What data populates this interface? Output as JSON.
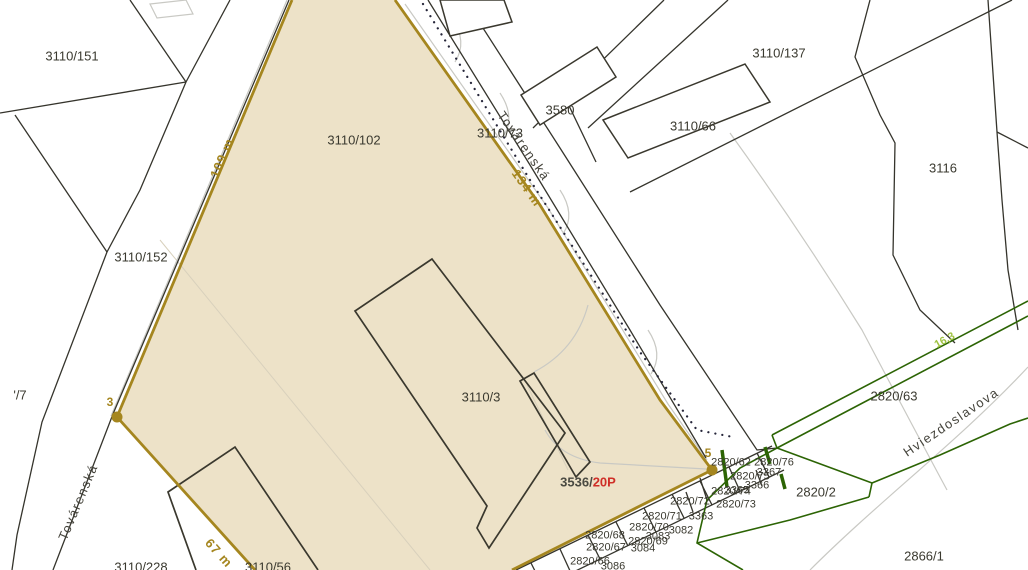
{
  "map": {
    "title": "cadastral-map-view",
    "colors": {
      "highlight_fill": "#ede2c8",
      "highlight_border": "#a5861f",
      "parcel_line": "#35342c",
      "building_line": "#3a382e",
      "helper_gray": "#c9c9c4",
      "dotted_line": "#26263a",
      "green_line": "#2c6404",
      "green_label": "#9fc241",
      "red_label": "#cf2e27",
      "dark_label": "#4a4a42",
      "label_gray": "#3a392f"
    },
    "selected_parcel": {
      "main_labels": [
        "3110/102",
        "3110/3"
      ],
      "edge_lengths": [
        "109 m",
        "134 m",
        "67 m"
      ],
      "boundary_points": [
        "3",
        "5"
      ],
      "detail_plan_ref": {
        "prefix": "3536/",
        "suffix": "20P"
      }
    },
    "streets": [
      "Továrenská",
      "Hviezdoslavova"
    ],
    "labels": [
      {
        "name": "parcel-3110-151",
        "text": "3110/151",
        "x": 72,
        "y": 56,
        "rot": 0,
        "cls": "parcel"
      },
      {
        "name": "parcel-3110-102",
        "text": "3110/102",
        "x": 354,
        "y": 140,
        "rot": 0,
        "cls": "parcel"
      },
      {
        "name": "parcel-3110-137",
        "text": "3110/137",
        "x": 779,
        "y": 53,
        "rot": 0,
        "cls": "parcel"
      },
      {
        "name": "parcel-3580",
        "text": "3580",
        "x": 560,
        "y": 110,
        "rot": 0,
        "cls": "parcel"
      },
      {
        "name": "parcel-3110-66",
        "text": "3110/66",
        "x": 693,
        "y": 126,
        "rot": 0,
        "cls": "parcel"
      },
      {
        "name": "parcel-3116",
        "text": "3116",
        "x": 943,
        "y": 168,
        "rot": 0,
        "cls": "parcel"
      },
      {
        "name": "parcel-3110-73",
        "text": "3110/73",
        "x": 500,
        "y": 133,
        "rot": 0,
        "cls": "parcel"
      },
      {
        "name": "parcel-3110-152",
        "text": "3110/152",
        "x": 141,
        "y": 257,
        "rot": 0,
        "cls": "parcel"
      },
      {
        "name": "parcel-slash7",
        "text": "'/7",
        "x": 20,
        "y": 395,
        "rot": 0,
        "cls": "parcel"
      },
      {
        "name": "parcel-3110-3",
        "text": "3110/3",
        "x": 481,
        "y": 397,
        "rot": 0,
        "cls": "parcel"
      },
      {
        "name": "parcel-2820-63",
        "text": "2820/63",
        "x": 894,
        "y": 396,
        "rot": 0,
        "cls": "parcel"
      },
      {
        "name": "parcel-2820-2",
        "text": "2820/2",
        "x": 816,
        "y": 492,
        "rot": 0,
        "cls": "parcel"
      },
      {
        "name": "parcel-2866-1",
        "text": "2866/1",
        "x": 924,
        "y": 556,
        "rot": 0,
        "cls": "parcel"
      },
      {
        "name": "parcel-3110-228",
        "text": "3110/228",
        "x": 141,
        "y": 567,
        "rot": 0,
        "cls": "parcel"
      },
      {
        "name": "parcel-3110-56",
        "text": "3110/56",
        "x": 268,
        "y": 567,
        "rot": 0,
        "cls": "parcel"
      },
      {
        "name": "parcel-2820-62",
        "text": "2820/62",
        "x": 731,
        "y": 463,
        "rot": 0,
        "cls": "parcel-sm"
      },
      {
        "name": "parcel-2820-76",
        "text": "2820/76",
        "x": 774,
        "y": 463,
        "rot": 0,
        "cls": "parcel-sm"
      },
      {
        "name": "parcel-2820-75",
        "text": "2820/75",
        "x": 750,
        "y": 477,
        "rot": 0,
        "cls": "parcel-sm"
      },
      {
        "name": "parcel-3367",
        "text": "3367",
        "x": 769,
        "y": 473,
        "rot": 0,
        "cls": "parcel-sm"
      },
      {
        "name": "parcel-3366",
        "text": "3366",
        "x": 757,
        "y": 486,
        "rot": 0,
        "cls": "parcel-sm"
      },
      {
        "name": "parcel-2820-74",
        "text": "2820/74",
        "x": 731,
        "y": 492,
        "rot": 0,
        "cls": "parcel-sm"
      },
      {
        "name": "parcel-3365",
        "text": "3365",
        "x": 737,
        "y": 491,
        "rot": 0,
        "cls": "parcel-sm"
      },
      {
        "name": "parcel-2820-73",
        "text": "2820/73",
        "x": 736,
        "y": 505,
        "rot": 0,
        "cls": "parcel-sm"
      },
      {
        "name": "parcel-2820-72",
        "text": "2820/72",
        "x": 690,
        "y": 502,
        "rot": 0,
        "cls": "parcel-sm"
      },
      {
        "name": "parcel-3363",
        "text": "3363",
        "x": 701,
        "y": 517,
        "rot": 0,
        "cls": "parcel-sm"
      },
      {
        "name": "parcel-2820-71",
        "text": "2820/71",
        "x": 662,
        "y": 517,
        "rot": 0,
        "cls": "parcel-sm"
      },
      {
        "name": "parcel-3082",
        "text": "3082",
        "x": 681,
        "y": 531,
        "rot": 0,
        "cls": "parcel-sm"
      },
      {
        "name": "parcel-2820-70",
        "text": "2820/70",
        "x": 649,
        "y": 528,
        "rot": 0,
        "cls": "parcel-sm"
      },
      {
        "name": "parcel-3083",
        "text": "3083",
        "x": 658,
        "y": 537,
        "rot": 0,
        "cls": "parcel-sm"
      },
      {
        "name": "parcel-2820-68",
        "text": "2820/68",
        "x": 605,
        "y": 536,
        "rot": 0,
        "cls": "parcel-sm"
      },
      {
        "name": "parcel-2820-69",
        "text": "2820/69",
        "x": 648,
        "y": 542,
        "rot": 0,
        "cls": "parcel-sm"
      },
      {
        "name": "parcel-2820-67",
        "text": "2820/67",
        "x": 606,
        "y": 548,
        "rot": 0,
        "cls": "parcel-sm"
      },
      {
        "name": "parcel-3084",
        "text": "3084",
        "x": 643,
        "y": 549,
        "rot": 0,
        "cls": "parcel-sm"
      },
      {
        "name": "parcel-2820-66",
        "text": "2820/66",
        "x": 590,
        "y": 562,
        "rot": 0,
        "cls": "parcel-sm"
      },
      {
        "name": "parcel-3086",
        "text": "3086",
        "x": 613,
        "y": 567,
        "rot": 0,
        "cls": "parcel-sm"
      },
      {
        "name": "street-tovarenska-top",
        "text": "Továrenská",
        "x": 524,
        "y": 146,
        "rot": 55,
        "cls": "street"
      },
      {
        "name": "street-tovarenska-bottom",
        "text": "Továrenská",
        "x": 78,
        "y": 502,
        "rot": -67,
        "cls": "street"
      },
      {
        "name": "street-hviezdoslavova",
        "text": "Hviezdoslavova",
        "x": 951,
        "y": 422,
        "rot": -34,
        "cls": "street"
      },
      {
        "name": "edge-length-109m",
        "text": "109 m",
        "x": 222,
        "y": 158,
        "rot": -67,
        "cls": "measure"
      },
      {
        "name": "edge-length-134m",
        "text": "134 m",
        "x": 527,
        "y": 188,
        "rot": 55,
        "cls": "measure"
      },
      {
        "name": "edge-length-67m",
        "text": "67 m",
        "x": 219,
        "y": 553,
        "rot": 48,
        "cls": "measure"
      },
      {
        "name": "boundary-point-3-label",
        "text": "3",
        "x": 110,
        "y": 402,
        "rot": 0,
        "cls": "point"
      },
      {
        "name": "boundary-point-5-label",
        "text": "5",
        "x": 708,
        "y": 453,
        "rot": 0,
        "cls": "point"
      },
      {
        "name": "green-measure-16-3",
        "text": "16,3",
        "x": 945,
        "y": 341,
        "rot": -29,
        "cls": "gmeasure"
      },
      {
        "name": "detail-plan-label",
        "x": 588,
        "y": 482,
        "rot": 0,
        "cls": "combo",
        "parts": [
          {
            "text": "3536/",
            "color": "#4a4a42"
          },
          {
            "text": "20P",
            "color": "#cf2e27"
          }
        ]
      }
    ]
  }
}
